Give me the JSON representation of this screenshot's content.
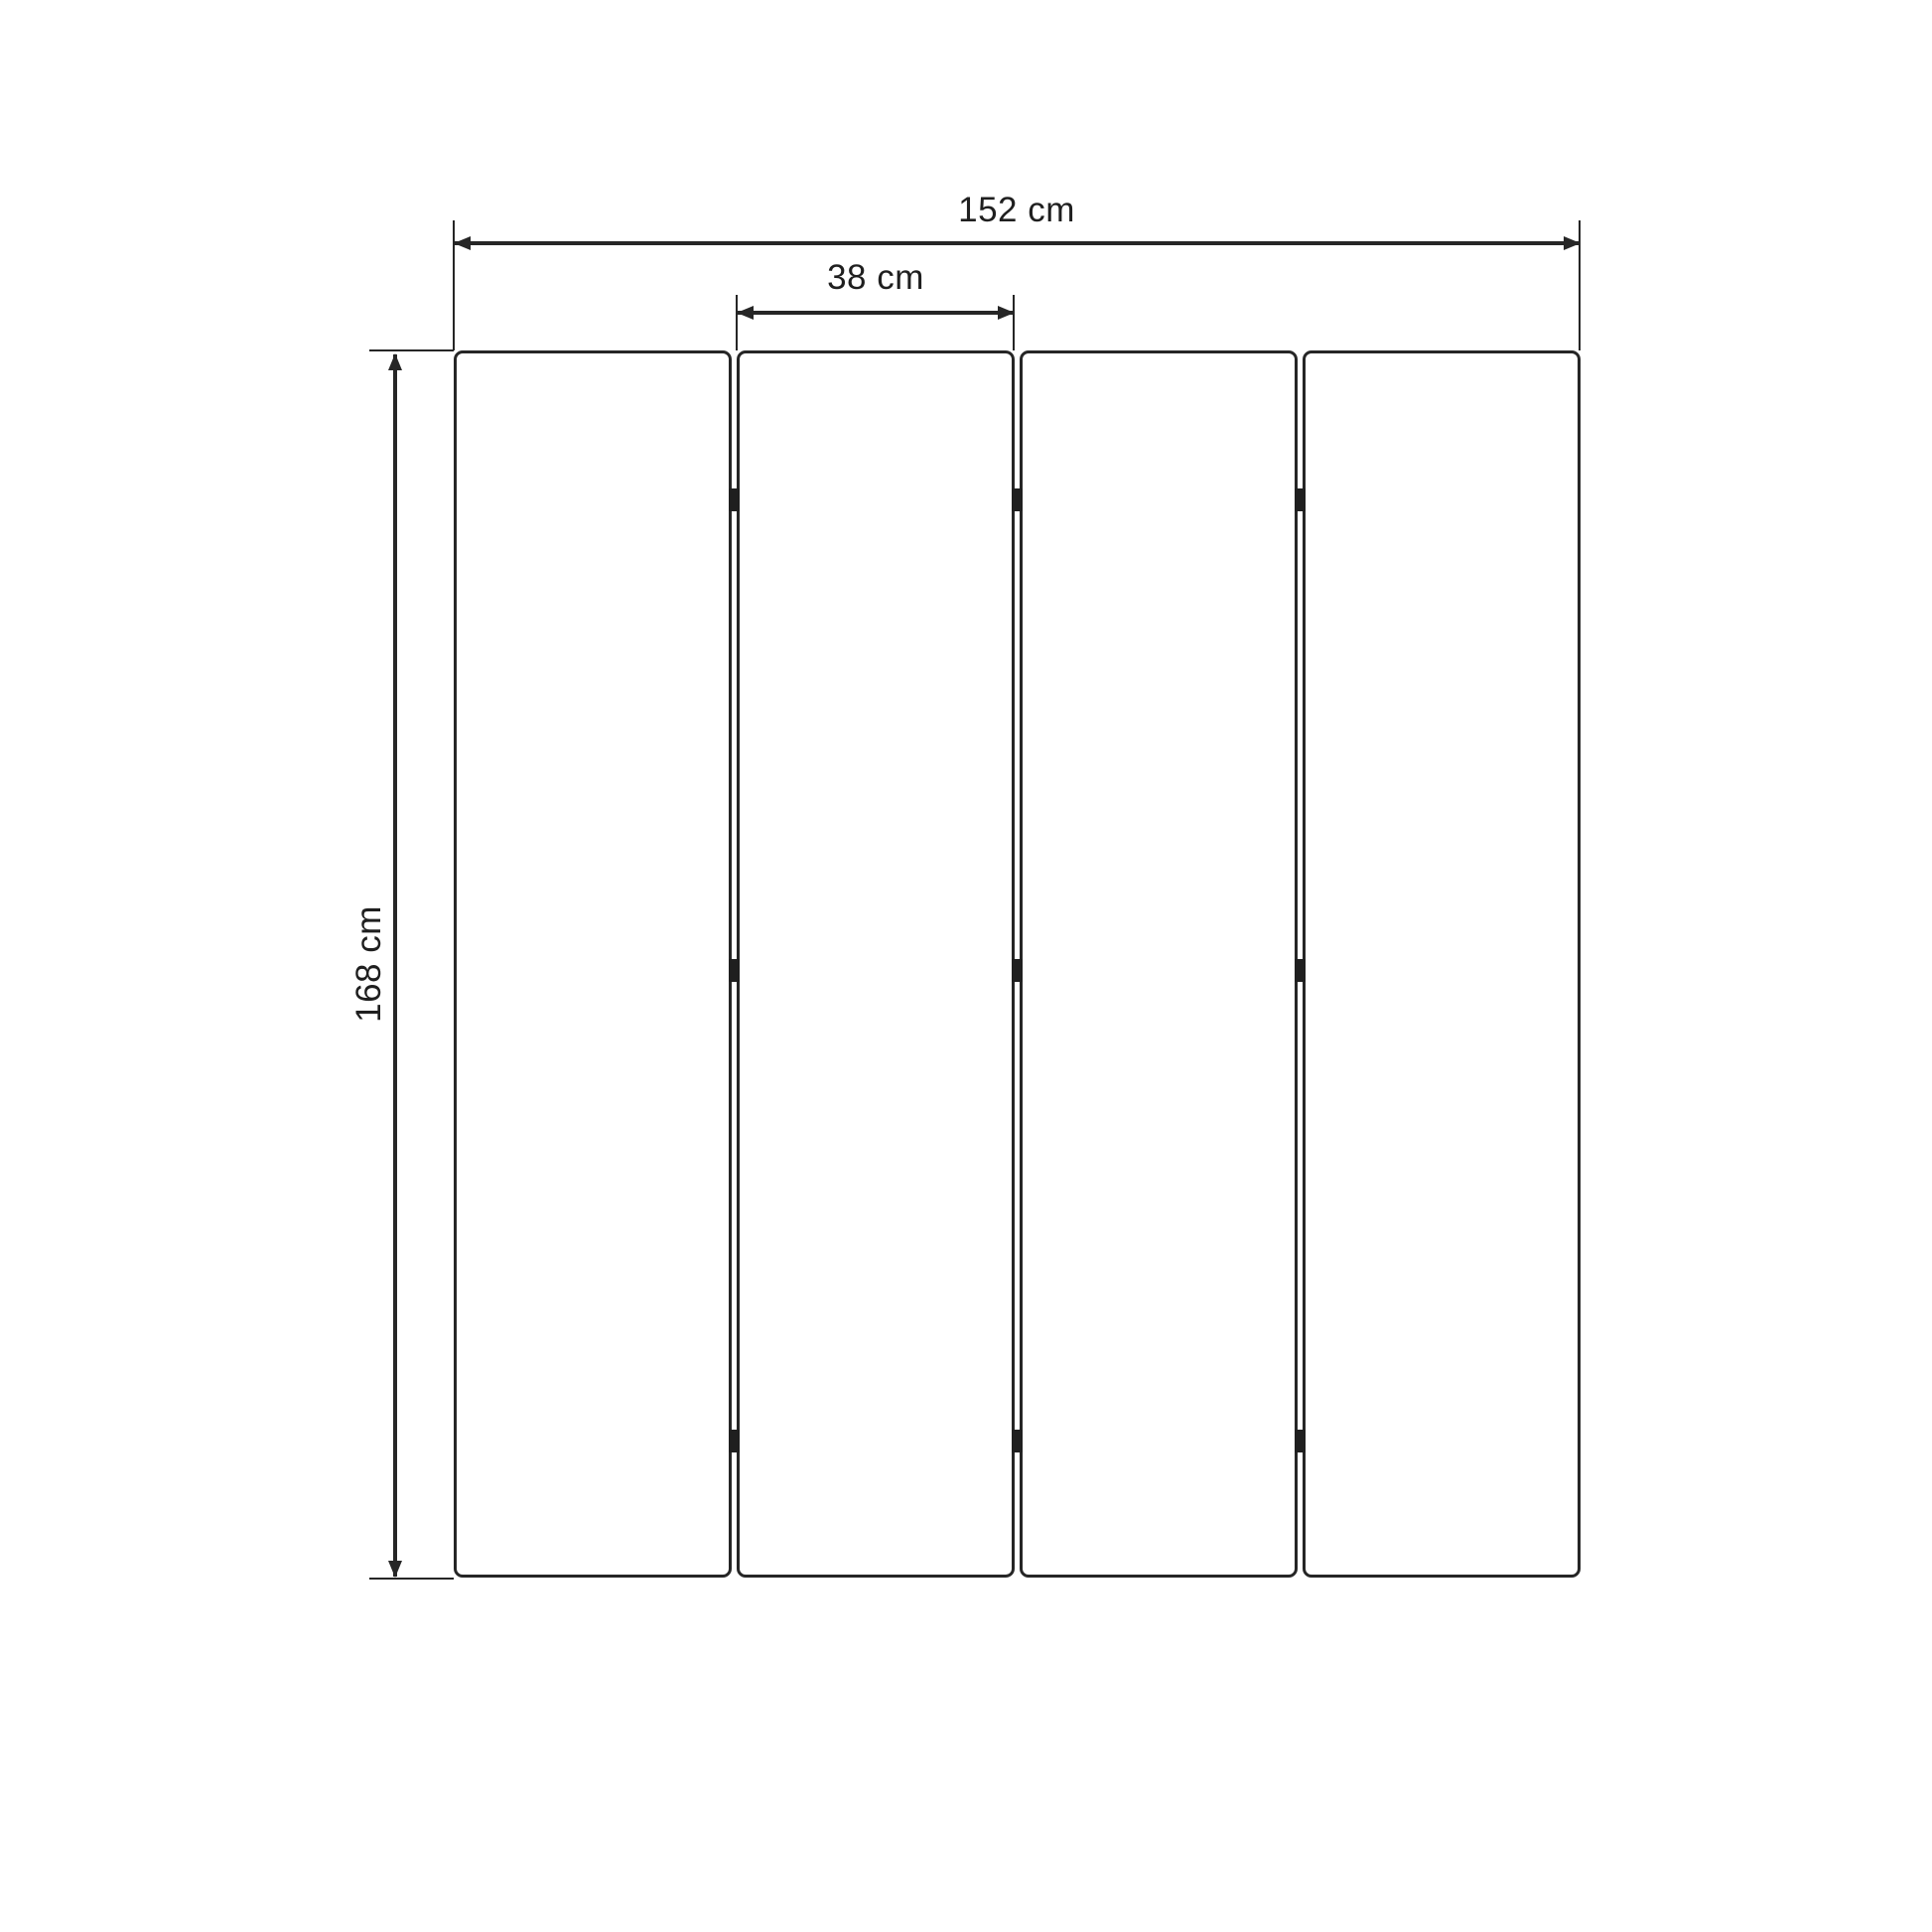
{
  "diagram": {
    "type": "furniture-dimension-drawing",
    "subject": "four-panel folding screen, front view",
    "labels": {
      "total_width": "152 cm",
      "panel_width": "38 cm",
      "height": "168 cm"
    },
    "structure": {
      "panel_count": 4,
      "gap_count": 3,
      "hinges_per_gap": 3
    },
    "colors": {
      "background": "#ffffff",
      "line": "#262626",
      "text": "#1f1f1f",
      "hinge": "#1f1f1f",
      "panel_fill": "#ffffff"
    }
  }
}
